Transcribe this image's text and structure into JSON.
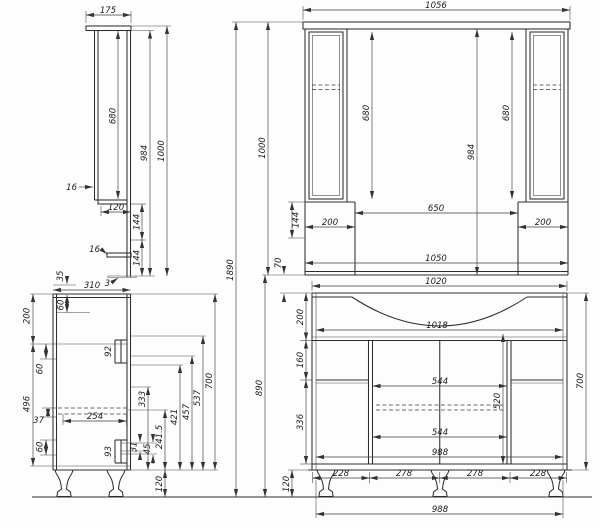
{
  "drawing": {
    "units": "mm",
    "total": {
      "h1890": "1890"
    },
    "mirror_side": {
      "width175": "175",
      "door680": "680",
      "h984": "984",
      "h1000": "1000",
      "t16_door": "16",
      "d120": "120",
      "h144a": "144",
      "t16_shelf": "16",
      "h144b": "144",
      "t3": "3"
    },
    "mirror_front": {
      "w1056": "1056",
      "l680": "680",
      "r680": "680",
      "h984": "984",
      "h1000": "1000",
      "h144": "144",
      "w650": "650",
      "w200l": "200",
      "w200r": "200",
      "w1050": "1050",
      "gap70": "70"
    },
    "vanity_side": {
      "gap35": "35",
      "depth310": "310",
      "h200": "200",
      "h60a": "60",
      "h60b": "60",
      "h496": "496",
      "h37": "37",
      "h60c": "60",
      "w254": "254",
      "h92": "92",
      "h31": "31",
      "h45": "45",
      "h333": "333",
      "h241_5": "241.5",
      "h421": "421",
      "h457": "457",
      "h537": "537",
      "h700": "700",
      "h93": "93",
      "leg120": "120"
    },
    "vanity_front": {
      "w1020": "1020",
      "h200": "200",
      "w1018": "1018",
      "h160": "160",
      "h890": "890",
      "h700": "700",
      "w544a": "544",
      "h520": "520",
      "h336": "336",
      "w544b": "544",
      "w988": "988",
      "s228a": "228",
      "s278a": "278",
      "s278b": "278",
      "s228b": "228",
      "leg120": "120",
      "base988": "988"
    }
  }
}
